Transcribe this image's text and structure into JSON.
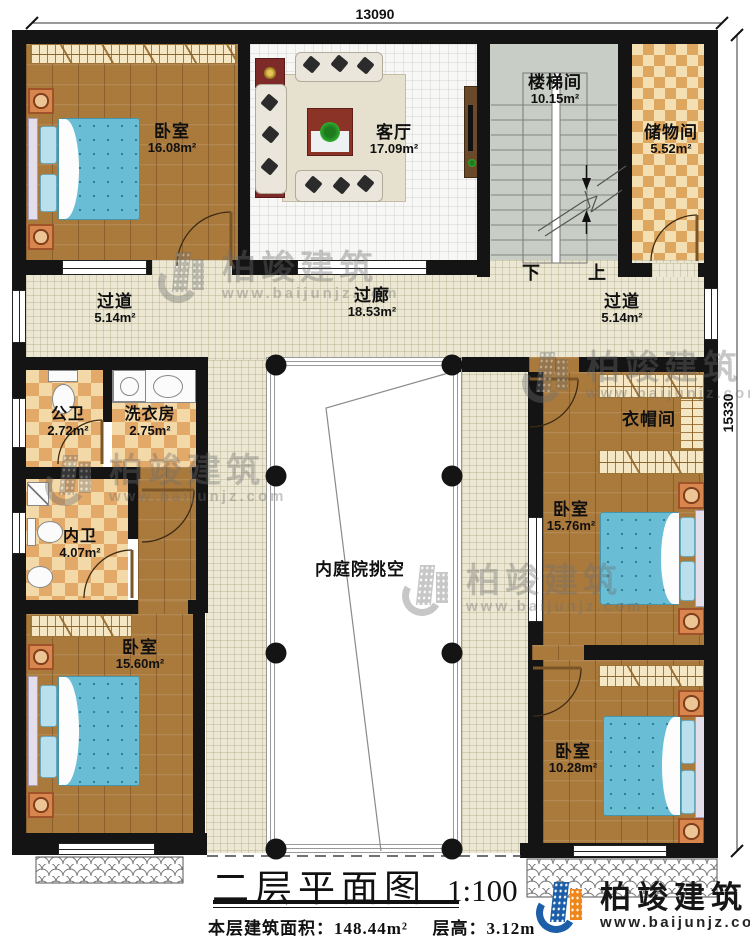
{
  "dimensions": {
    "top": "13090",
    "right": "15330"
  },
  "rooms": {
    "bedroom_tl": {
      "name": "卧室",
      "area": "16.08m²"
    },
    "living": {
      "name": "客厅",
      "area": "17.09m²"
    },
    "stairwell": {
      "name": "楼梯间",
      "area": "10.15m²"
    },
    "storage": {
      "name": "储物间",
      "area": "5.52m²"
    },
    "corridor_left": {
      "name": "过道",
      "area": "5.14m²"
    },
    "gallery": {
      "name": "过廊",
      "area": "18.53m²"
    },
    "corridor_right": {
      "name": "过道",
      "area": "5.14m²"
    },
    "bath_public": {
      "name": "公卫",
      "area": "2.72m²"
    },
    "laundry": {
      "name": "洗衣房",
      "area": "2.75m²"
    },
    "bath_private": {
      "name": "内卫",
      "area": "4.07m²"
    },
    "cloakroom": {
      "name": "衣帽间"
    },
    "bedroom_r1": {
      "name": "卧室",
      "area": "15.76m²"
    },
    "bedroom_bl": {
      "name": "卧室",
      "area": "15.60m²"
    },
    "bedroom_r2": {
      "name": "卧室",
      "area": "10.28m²"
    },
    "courtyard": {
      "name": "内庭院挑空"
    }
  },
  "stairs": {
    "down_label": "下",
    "up_label": "上"
  },
  "title_block": {
    "title": "二层平面图",
    "scale": "1:100",
    "floor_area_label": "本层建筑面积：",
    "floor_area_value": "148.44m²",
    "floor_height_label": "层高：",
    "floor_height_value": "3.12m"
  },
  "branding": {
    "company": "柏竣建筑",
    "website": "www.baijunjz.com"
  },
  "watermark": {
    "company": "柏竣建筑",
    "website": "www.baijunjz.com"
  },
  "colors": {
    "wall": "#141414",
    "wood_floor": "#aa7a3d",
    "tile_cream": "#ebe7d3",
    "tile_white": "#f7f7f5",
    "stair_floor": "#c8cec5",
    "checker_orange": "#e3a968",
    "bed_blue": "#69bed6",
    "logo_blue": "#1c5fa8",
    "logo_orange": "#f08519"
  }
}
